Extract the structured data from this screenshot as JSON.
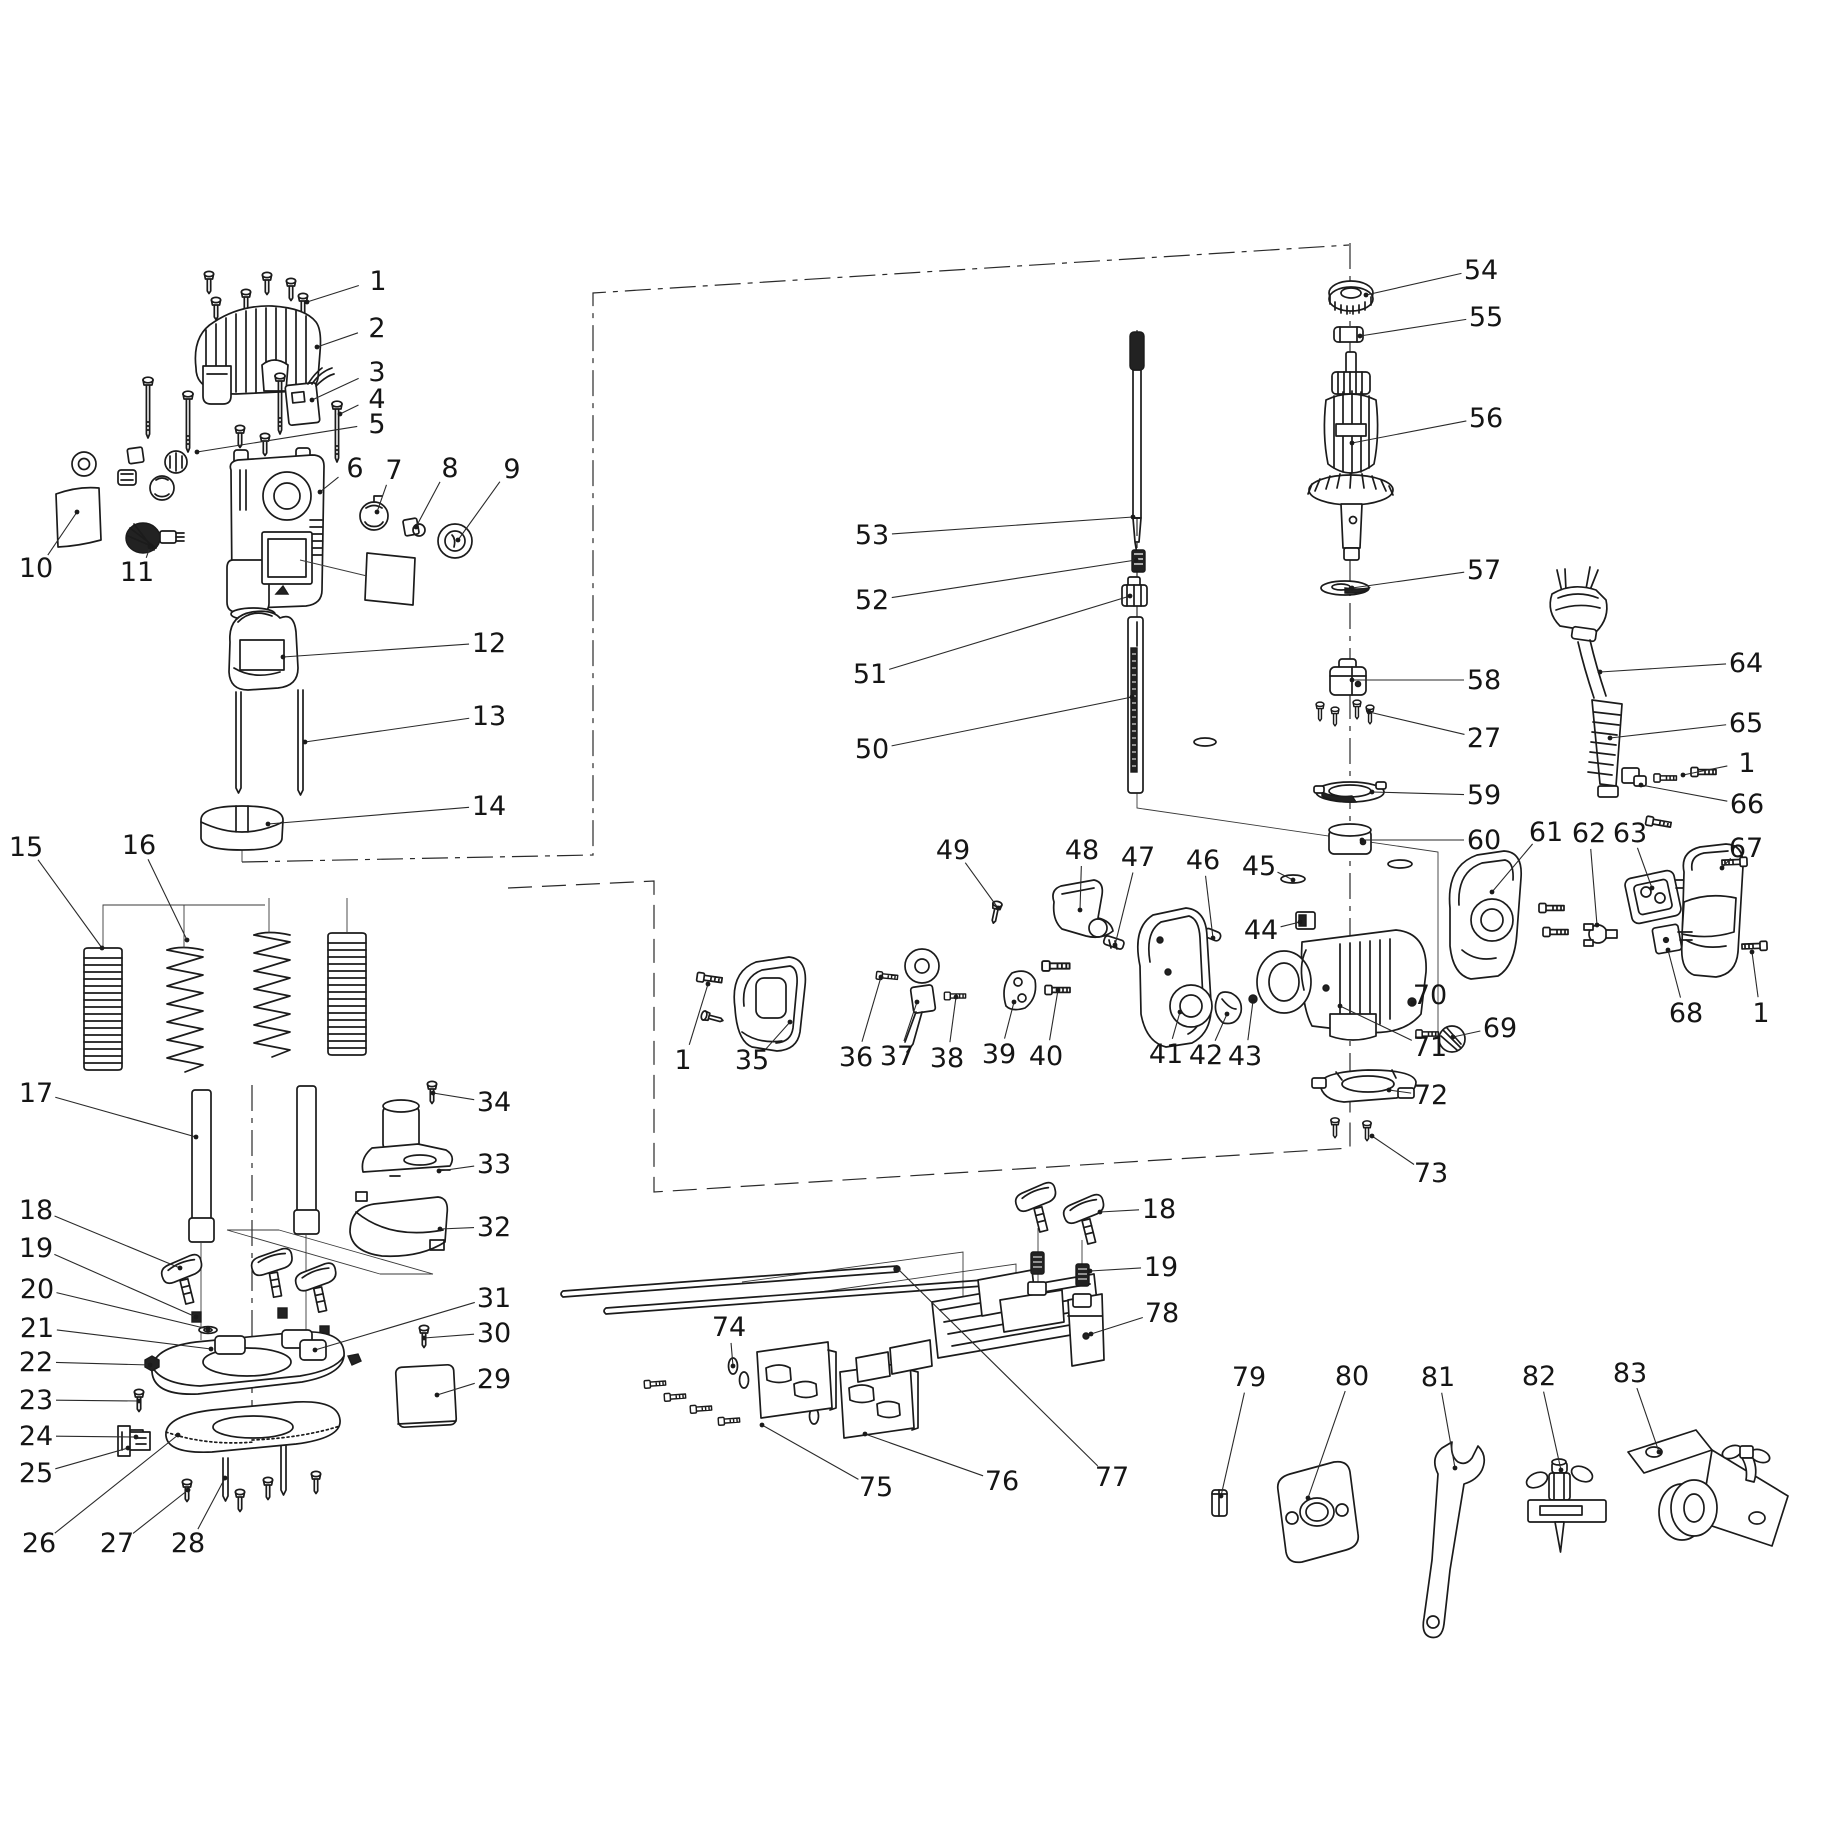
{
  "diagram": {
    "type": "exploded-parts-diagram",
    "subject": "plunge-router-power-tool-spare-parts",
    "canvas": {
      "width": 1823,
      "height": 1823,
      "background": "#ffffff",
      "line_color": "#1b1b1b"
    },
    "callouts": [
      {
        "n": "1",
        "x": 378,
        "y": 281,
        "tx": 307,
        "ty": 302
      },
      {
        "n": "2",
        "x": 377,
        "y": 328,
        "tx": 317,
        "ty": 347
      },
      {
        "n": "3",
        "x": 377,
        "y": 372,
        "tx": 312,
        "ty": 400
      },
      {
        "n": "4",
        "x": 377,
        "y": 399,
        "tx": 340,
        "ty": 414
      },
      {
        "n": "5",
        "x": 377,
        "y": 424,
        "tx": 197,
        "ty": 452
      },
      {
        "n": "6",
        "x": 355,
        "y": 468,
        "tx": 320,
        "ty": 492
      },
      {
        "n": "7",
        "x": 394,
        "y": 470,
        "tx": 377,
        "ty": 512
      },
      {
        "n": "8",
        "x": 450,
        "y": 468,
        "tx": 416,
        "ty": 527
      },
      {
        "n": "9",
        "x": 512,
        "y": 469,
        "tx": 458,
        "ty": 540
      },
      {
        "n": "10",
        "x": 36,
        "y": 568,
        "tx": 77,
        "ty": 512
      },
      {
        "n": "11",
        "x": 137,
        "y": 572,
        "tx": 150,
        "ty": 547
      },
      {
        "n": "12",
        "x": 489,
        "y": 643,
        "tx": 283,
        "ty": 657
      },
      {
        "n": "13",
        "x": 489,
        "y": 716,
        "tx": 305,
        "ty": 742
      },
      {
        "n": "14",
        "x": 489,
        "y": 806,
        "tx": 268,
        "ty": 824
      },
      {
        "n": "15",
        "x": 26,
        "y": 847,
        "tx": 102,
        "ty": 948
      },
      {
        "n": "16",
        "x": 139,
        "y": 845,
        "tx": 187,
        "ty": 940
      },
      {
        "n": "17",
        "x": 36,
        "y": 1093,
        "tx": 196,
        "ty": 1137
      },
      {
        "n": "18",
        "x": 36,
        "y": 1210,
        "tx": 180,
        "ty": 1268
      },
      {
        "n": "19",
        "x": 36,
        "y": 1248,
        "tx": 196,
        "ty": 1317
      },
      {
        "n": "20",
        "x": 37,
        "y": 1289,
        "tx": 208,
        "ty": 1329
      },
      {
        "n": "21",
        "x": 37,
        "y": 1328,
        "tx": 211,
        "ty": 1349
      },
      {
        "n": "22",
        "x": 36,
        "y": 1362,
        "tx": 150,
        "ty": 1365
      },
      {
        "n": "23",
        "x": 36,
        "y": 1400,
        "tx": 139,
        "ty": 1401
      },
      {
        "n": "24",
        "x": 36,
        "y": 1436,
        "tx": 136,
        "ty": 1437
      },
      {
        "n": "25",
        "x": 36,
        "y": 1473,
        "tx": 128,
        "ty": 1448
      },
      {
        "n": "26",
        "x": 39,
        "y": 1543,
        "tx": 178,
        "ty": 1435
      },
      {
        "n": "27",
        "x": 117,
        "y": 1543,
        "tx": 188,
        "ty": 1490
      },
      {
        "n": "28",
        "x": 188,
        "y": 1543,
        "tx": 225,
        "ty": 1478
      },
      {
        "n": "29",
        "x": 494,
        "y": 1379,
        "tx": 437,
        "ty": 1395
      },
      {
        "n": "30",
        "x": 494,
        "y": 1333,
        "tx": 424,
        "ty": 1338
      },
      {
        "n": "31",
        "x": 494,
        "y": 1298,
        "tx": 315,
        "ty": 1350
      },
      {
        "n": "32",
        "x": 494,
        "y": 1227,
        "tx": 440,
        "ty": 1229
      },
      {
        "n": "33",
        "x": 494,
        "y": 1164,
        "tx": 439,
        "ty": 1171
      },
      {
        "n": "34",
        "x": 494,
        "y": 1102,
        "tx": 433,
        "ty": 1093
      },
      {
        "n": "53",
        "x": 872,
        "y": 535,
        "tx": 1133,
        "ty": 517
      },
      {
        "n": "52",
        "x": 872,
        "y": 600,
        "tx": 1136,
        "ty": 560
      },
      {
        "n": "51",
        "x": 870,
        "y": 674,
        "tx": 1130,
        "ty": 596
      },
      {
        "n": "50",
        "x": 872,
        "y": 749,
        "tx": 1132,
        "ty": 697
      },
      {
        "n": "54",
        "x": 1481,
        "y": 270,
        "tx": 1366,
        "ty": 295
      },
      {
        "n": "55",
        "x": 1486,
        "y": 317,
        "tx": 1360,
        "ty": 336
      },
      {
        "n": "56",
        "x": 1486,
        "y": 418,
        "tx": 1352,
        "ty": 443
      },
      {
        "n": "57",
        "x": 1484,
        "y": 570,
        "tx": 1352,
        "ty": 588
      },
      {
        "n": "58",
        "x": 1484,
        "y": 680,
        "tx": 1352,
        "ty": 680
      },
      {
        "n": "27",
        "x": 1484,
        "y": 738,
        "tx": 1369,
        "ty": 712
      },
      {
        "n": "59",
        "x": 1484,
        "y": 795,
        "tx": 1372,
        "ty": 792
      },
      {
        "n": "60",
        "x": 1484,
        "y": 840,
        "tx": 1362,
        "ty": 840
      },
      {
        "n": "64",
        "x": 1746,
        "y": 663,
        "tx": 1600,
        "ty": 672
      },
      {
        "n": "65",
        "x": 1746,
        "y": 723,
        "tx": 1610,
        "ty": 738
      },
      {
        "n": "1",
        "x": 1747,
        "y": 763,
        "tx": 1683,
        "ty": 775
      },
      {
        "n": "66",
        "x": 1747,
        "y": 804,
        "tx": 1641,
        "ty": 785
      },
      {
        "n": "67",
        "x": 1746,
        "y": 848,
        "tx": 1722,
        "ty": 868
      },
      {
        "n": "61",
        "x": 1546,
        "y": 832,
        "tx": 1492,
        "ty": 892
      },
      {
        "n": "62",
        "x": 1589,
        "y": 833,
        "tx": 1597,
        "ty": 925
      },
      {
        "n": "63",
        "x": 1630,
        "y": 833,
        "tx": 1652,
        "ty": 888
      },
      {
        "n": "68",
        "x": 1686,
        "y": 1013,
        "tx": 1668,
        "ty": 950
      },
      {
        "n": "1",
        "x": 1761,
        "y": 1013,
        "tx": 1752,
        "ty": 952
      },
      {
        "n": "49",
        "x": 953,
        "y": 850,
        "tx": 998,
        "ty": 908
      },
      {
        "n": "48",
        "x": 1082,
        "y": 850,
        "tx": 1080,
        "ty": 910
      },
      {
        "n": "47",
        "x": 1138,
        "y": 857,
        "tx": 1115,
        "ty": 945
      },
      {
        "n": "46",
        "x": 1203,
        "y": 860,
        "tx": 1213,
        "ty": 938
      },
      {
        "n": "45",
        "x": 1259,
        "y": 866,
        "tx": 1293,
        "ty": 880
      },
      {
        "n": "44",
        "x": 1261,
        "y": 930,
        "tx": 1300,
        "ty": 922
      },
      {
        "n": "1",
        "x": 683,
        "y": 1060,
        "tx": 708,
        "ty": 984
      },
      {
        "n": "35",
        "x": 752,
        "y": 1060,
        "tx": 790,
        "ty": 1022
      },
      {
        "n": "36",
        "x": 856,
        "y": 1057,
        "tx": 881,
        "ty": 977
      },
      {
        "n": "37",
        "x": 897,
        "y": 1056,
        "tx": 917,
        "ty": 1002
      },
      {
        "n": "38",
        "x": 947,
        "y": 1058,
        "tx": 956,
        "ty": 997
      },
      {
        "n": "39",
        "x": 999,
        "y": 1054,
        "tx": 1014,
        "ty": 1002
      },
      {
        "n": "40",
        "x": 1046,
        "y": 1056,
        "tx": 1058,
        "ty": 990
      },
      {
        "n": "41",
        "x": 1166,
        "y": 1054,
        "tx": 1180,
        "ty": 1012
      },
      {
        "n": "42",
        "x": 1206,
        "y": 1055,
        "tx": 1227,
        "ty": 1014
      },
      {
        "n": "43",
        "x": 1245,
        "y": 1056,
        "tx": 1253,
        "ty": 1001
      },
      {
        "n": "70",
        "x": 1430,
        "y": 995,
        "tx": 1413,
        "ty": 1003
      },
      {
        "n": "69",
        "x": 1500,
        "y": 1028,
        "tx": 1453,
        "ty": 1037
      },
      {
        "n": "71",
        "x": 1430,
        "y": 1047,
        "tx": 1340,
        "ty": 1006
      },
      {
        "n": "72",
        "x": 1431,
        "y": 1095,
        "tx": 1389,
        "ty": 1090
      },
      {
        "n": "73",
        "x": 1431,
        "y": 1173,
        "tx": 1372,
        "ty": 1136
      },
      {
        "n": "74",
        "x": 729,
        "y": 1327,
        "tx": 733,
        "ty": 1366
      },
      {
        "n": "75",
        "x": 876,
        "y": 1487,
        "tx": 762,
        "ty": 1425
      },
      {
        "n": "76",
        "x": 1002,
        "y": 1481,
        "tx": 865,
        "ty": 1434
      },
      {
        "n": "77",
        "x": 1112,
        "y": 1477,
        "tx": 897,
        "ty": 1268
      },
      {
        "n": "18",
        "x": 1159,
        "y": 1209,
        "tx": 1100,
        "ty": 1212
      },
      {
        "n": "19",
        "x": 1161,
        "y": 1267,
        "tx": 1090,
        "ty": 1271
      },
      {
        "n": "78",
        "x": 1162,
        "y": 1313,
        "tx": 1091,
        "ty": 1334
      },
      {
        "n": "79",
        "x": 1249,
        "y": 1377,
        "tx": 1221,
        "ty": 1496
      },
      {
        "n": "80",
        "x": 1352,
        "y": 1376,
        "tx": 1308,
        "ty": 1498
      },
      {
        "n": "81",
        "x": 1438,
        "y": 1377,
        "tx": 1455,
        "ty": 1468
      },
      {
        "n": "82",
        "x": 1539,
        "y": 1376,
        "tx": 1561,
        "ty": 1470
      },
      {
        "n": "83",
        "x": 1630,
        "y": 1373,
        "tx": 1659,
        "ty": 1452
      }
    ],
    "construction_lines": [
      {
        "style": "dashdot",
        "points": [
          [
            242,
            862
          ],
          [
            593,
            855
          ],
          [
            593,
            293
          ],
          [
            1349,
            245
          ]
        ]
      },
      {
        "style": "dash",
        "points": [
          [
            508,
            888
          ],
          [
            654,
            881
          ],
          [
            654,
            1192
          ],
          [
            1350,
            1148
          ],
          [
            1350,
            1078
          ]
        ]
      },
      {
        "style": "dashdot",
        "points": [
          [
            252,
            1085
          ],
          [
            252,
            1412
          ]
        ]
      },
      {
        "style": "dashdot",
        "points": [
          [
            1350,
            243
          ],
          [
            1350,
            1072
          ]
        ]
      },
      {
        "style": "dashdot",
        "points": [
          [
            1137,
            330
          ],
          [
            1137,
            793
          ]
        ]
      },
      {
        "style": "thin",
        "points": [
          [
            1137,
            793
          ],
          [
            1137,
            808
          ],
          [
            1438,
            852
          ],
          [
            1438,
            1055
          ]
        ]
      },
      {
        "style": "thin",
        "points": [
          [
            963,
            1312
          ],
          [
            963,
            1252
          ],
          [
            742,
            1282
          ]
        ]
      },
      {
        "style": "thin",
        "points": [
          [
            1016,
            1312
          ],
          [
            1016,
            1264
          ],
          [
            820,
            1292
          ]
        ]
      },
      {
        "style": "thin",
        "points": [
          [
            227,
            1230
          ],
          [
            380,
            1274
          ]
        ]
      },
      {
        "style": "thin",
        "points": [
          [
            279,
            1230
          ],
          [
            433,
            1274
          ]
        ]
      },
      {
        "style": "thin",
        "points": [
          [
            227,
            1230
          ],
          [
            279,
            1230
          ]
        ]
      },
      {
        "style": "thin",
        "points": [
          [
            380,
            1274
          ],
          [
            433,
            1274
          ]
        ]
      },
      {
        "style": "thin",
        "points": [
          [
            1038,
            1228
          ],
          [
            1038,
            1292
          ]
        ]
      },
      {
        "style": "thin",
        "points": [
          [
            1082,
            1240
          ],
          [
            1082,
            1302
          ]
        ]
      },
      {
        "style": "thin",
        "points": [
          [
            242,
            848
          ],
          [
            242,
            862
          ]
        ]
      }
    ]
  }
}
